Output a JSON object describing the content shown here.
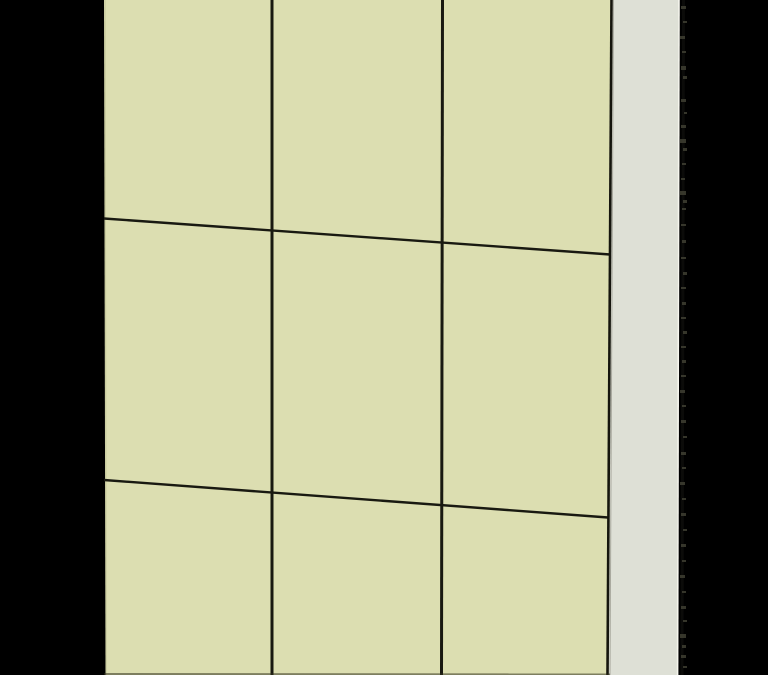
{
  "scene": {
    "kind": "3d-render-viewport",
    "subject": "paneled wall in perspective, receding to the right",
    "canvas": {
      "width": 768,
      "height": 675
    },
    "colors": {
      "background": "#000000",
      "panel_face": "#dcdeb1",
      "side_face": "#dee0d6",
      "seam": "#191911",
      "boundary_seam": "#15150d",
      "boundary_inner_gray": "#9b9b90",
      "left_edge_shade": "#b9bb90",
      "side_edge_highlight": "#f6f6ee",
      "bottom_edge_shadow": "#2f2f1c",
      "speck": "#474738",
      "speck_smear": "#20201a"
    },
    "wall_front_face": {
      "points": [
        [
          104,
          0
        ],
        [
          611.5,
          0
        ],
        [
          607.5,
          675
        ],
        [
          105.5,
          675
        ]
      ],
      "visible_columns": 3,
      "visible_rows": 3
    },
    "wall_side_face": {
      "points": [
        [
          612,
          0
        ],
        [
          678.5,
          0
        ],
        [
          677,
          675
        ],
        [
          608.5,
          675
        ]
      ]
    },
    "vertical_seams": [
      {
        "x1": 272,
        "y1": 0,
        "x2": 272,
        "y2": 675,
        "width": 3
      },
      {
        "x1": 442.5,
        "y1": 0,
        "x2": 441.5,
        "y2": 675,
        "width": 3
      }
    ],
    "horizontal_seams": [
      {
        "x1": 104,
        "y1": 218.5,
        "x2": 610,
        "y2": 254.5,
        "width": 2.4
      },
      {
        "x1": 104,
        "y1": 480,
        "x2": 608,
        "y2": 517.5,
        "width": 2.4
      }
    ],
    "boundary_seam_line": {
      "x1": 611.5,
      "y1": 0,
      "x2": 607.5,
      "y2": 675,
      "width": 2.6
    },
    "boundary_inner_line": {
      "x1": 613.5,
      "y1": 0,
      "x2": 610,
      "y2": 675,
      "width": 1
    },
    "left_edge_line": {
      "x1": 105,
      "y1": 0,
      "x2": 106.2,
      "y2": 675,
      "width": 1.2
    },
    "side_edge_highlight_line": {
      "x1": 679,
      "y1": 0,
      "x2": 677.6,
      "y2": 675,
      "width": 1.6
    },
    "bottom_edge_shadow_line": {
      "x1": 104,
      "y1": 674,
      "x2": 610,
      "y2": 674.4,
      "width": 2
    },
    "speck_smear_line": {
      "x1": 683.5,
      "y1": 0,
      "x2": 682,
      "y2": 675,
      "width": 3
    },
    "edge_specks": [
      [
        681,
        6,
        5,
        3
      ],
      [
        683,
        21,
        4,
        2
      ],
      [
        680,
        36,
        5,
        3
      ],
      [
        682,
        51,
        4,
        2
      ],
      [
        681,
        66,
        5,
        4
      ],
      [
        683,
        76,
        4,
        3
      ],
      [
        681,
        99,
        5,
        3
      ],
      [
        684,
        112,
        3,
        2
      ],
      [
        681,
        125,
        5,
        3
      ],
      [
        680,
        139,
        6,
        4
      ],
      [
        683,
        148,
        4,
        3
      ],
      [
        682,
        163,
        4,
        2
      ],
      [
        681,
        178,
        4,
        2
      ],
      [
        680,
        191,
        6,
        4
      ],
      [
        683,
        200,
        4,
        3
      ],
      [
        682,
        208,
        4,
        2
      ],
      [
        681,
        224,
        5,
        2
      ],
      [
        682,
        240,
        4,
        3
      ],
      [
        681,
        257,
        5,
        2
      ],
      [
        683,
        272,
        4,
        3
      ],
      [
        681,
        287,
        5,
        2
      ],
      [
        682,
        302,
        4,
        3
      ],
      [
        681,
        317,
        5,
        2
      ],
      [
        683,
        331,
        4,
        3
      ],
      [
        681,
        346,
        5,
        2
      ],
      [
        682,
        360,
        4,
        3
      ],
      [
        681,
        375,
        5,
        2
      ],
      [
        680,
        390,
        5,
        3
      ],
      [
        682,
        405,
        4,
        2
      ],
      [
        681,
        420,
        5,
        3
      ],
      [
        683,
        436,
        4,
        2
      ],
      [
        681,
        452,
        5,
        3
      ],
      [
        682,
        467,
        4,
        2
      ],
      [
        680,
        482,
        5,
        3
      ],
      [
        682,
        498,
        4,
        2
      ],
      [
        681,
        513,
        5,
        3
      ],
      [
        683,
        529,
        4,
        2
      ],
      [
        681,
        544,
        5,
        3
      ],
      [
        682,
        560,
        4,
        2
      ],
      [
        680,
        575,
        5,
        3
      ],
      [
        682,
        591,
        4,
        2
      ],
      [
        681,
        606,
        5,
        3
      ],
      [
        683,
        620,
        4,
        2
      ],
      [
        680,
        634,
        6,
        4
      ],
      [
        682,
        645,
        4,
        3
      ],
      [
        681,
        655,
        5,
        3
      ],
      [
        683,
        666,
        4,
        2
      ]
    ]
  }
}
